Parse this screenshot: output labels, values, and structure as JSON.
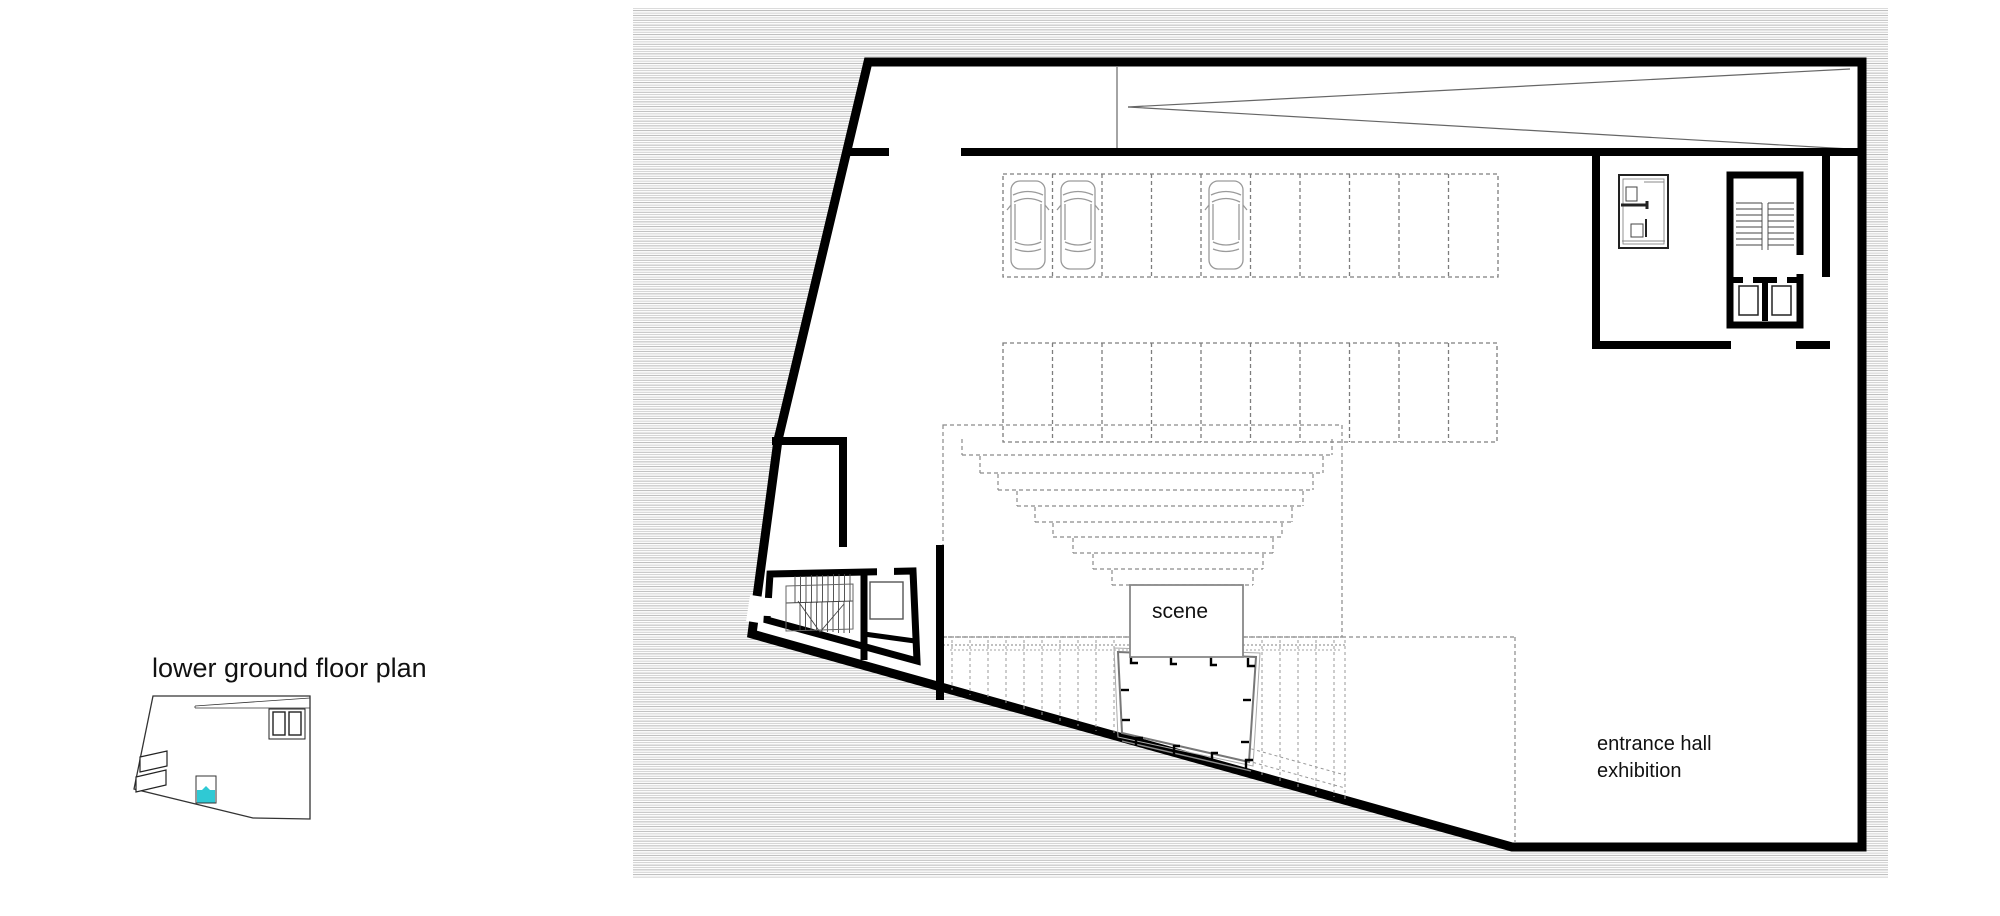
{
  "key_plan": {
    "label": "lower ground floor plan"
  },
  "plan_labels": {
    "scene": "scene",
    "entrance_line1": "entrance hall",
    "entrance_line2": "exhibition"
  },
  "colors": {
    "highlight_cyan": "#2FC9D4",
    "wall_black": "#000000",
    "hatch_gray": "#ACACAC",
    "dash_gray": "#8A8A8A",
    "stage_gray": "#777777",
    "car_gray": "#9A9A9A"
  }
}
